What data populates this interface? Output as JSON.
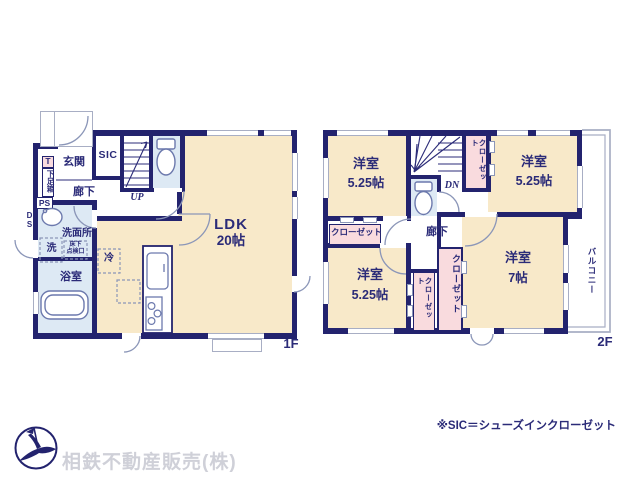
{
  "f1": {
    "floor_label": "1F",
    "genkan": "玄関",
    "sic": "SIC",
    "t_box": "T",
    "shoe_box": "下足箱",
    "ps": "PS",
    "ds": "DS",
    "hallway": "廊下",
    "up": "UP",
    "ldk_name": "LDK",
    "ldk_size": "20帖",
    "washroom": "洗面所",
    "washer": "洗",
    "hatch_line1": "床下",
    "hatch_line2": "点検口",
    "bathroom": "浴室",
    "fridge": "冷"
  },
  "f2": {
    "floor_label": "2F",
    "room_tl_name": "洋室",
    "room_tl_size": "5.25帖",
    "room_tr_name": "洋室",
    "room_tr_size": "5.25帖",
    "room_bl_name": "洋室",
    "room_bl_size": "5.25帖",
    "room_br_name": "洋室",
    "room_br_size": "7帖",
    "closet_top": "クローゼット",
    "closet_left": "クローゼット",
    "closet_mid_small": "クローゼット",
    "closet_mid_large": "クローゼット",
    "dn": "DN",
    "hallway": "廊下",
    "balcony": "バルコニー"
  },
  "footer": {
    "note": "※SIC＝シューズインクローゼット",
    "company": "相鉄不動産販売(株)",
    "logo": "sotetsu-bird-logo"
  },
  "colors": {
    "wall": "#23236e",
    "text": "#2b2b78",
    "room_cream": "#f8e9c9",
    "room_blue": "#dde9f4",
    "room_pink": "#f9dbde",
    "window_gray": "#a8aec4",
    "company_gray": "#cfd0d8"
  }
}
